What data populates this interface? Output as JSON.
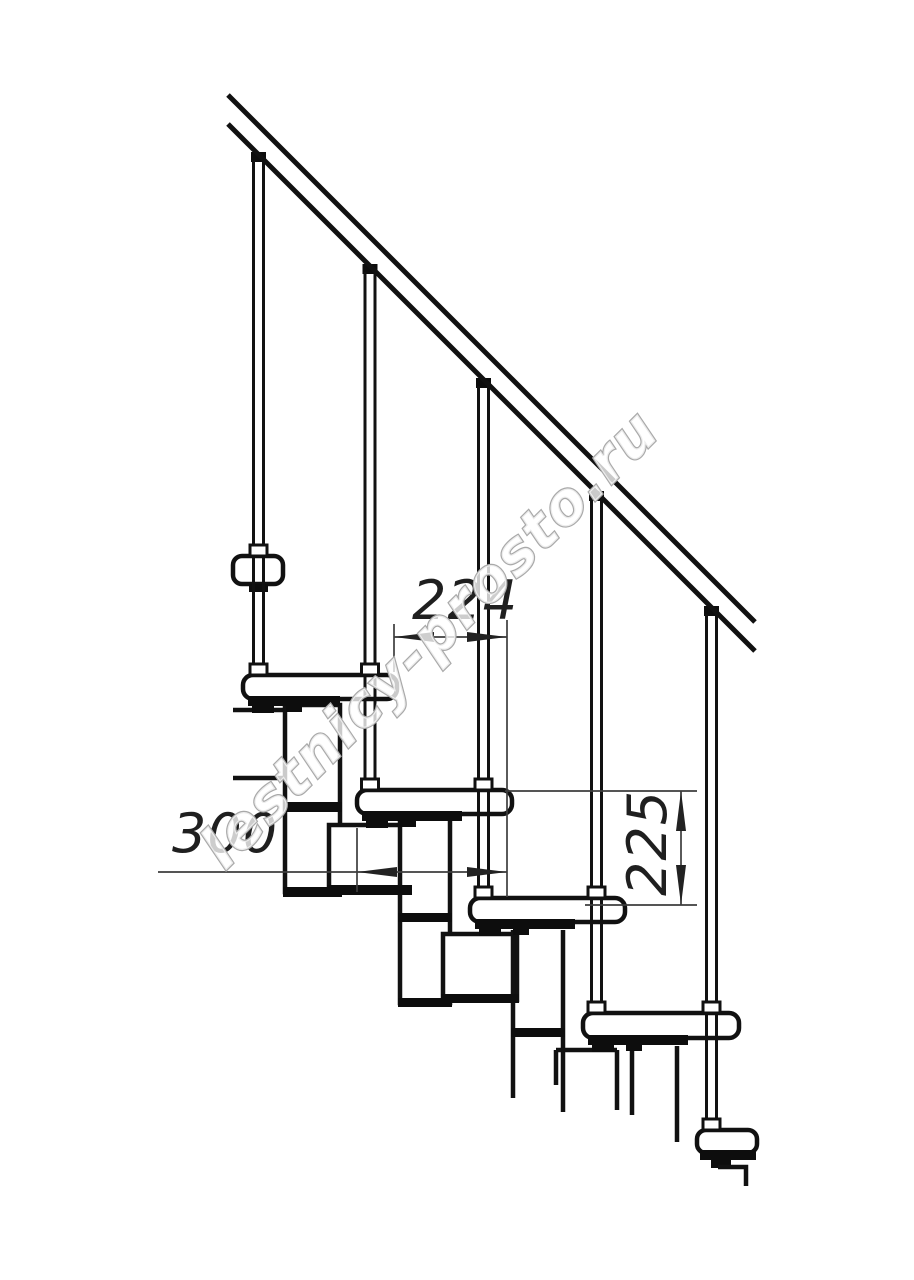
{
  "title": "Modular staircase side-view technical drawing",
  "drawing": {
    "dimensions": {
      "tread_run": "224",
      "tread_depth": "300",
      "step_rise": "225"
    },
    "watermark": "lestnicy-prosto.ru",
    "colors": {
      "line": "#111111",
      "dimension_line": "#3d3d3d",
      "watermark_outline": "#a9a9a9",
      "background": "#ffffff"
    }
  }
}
